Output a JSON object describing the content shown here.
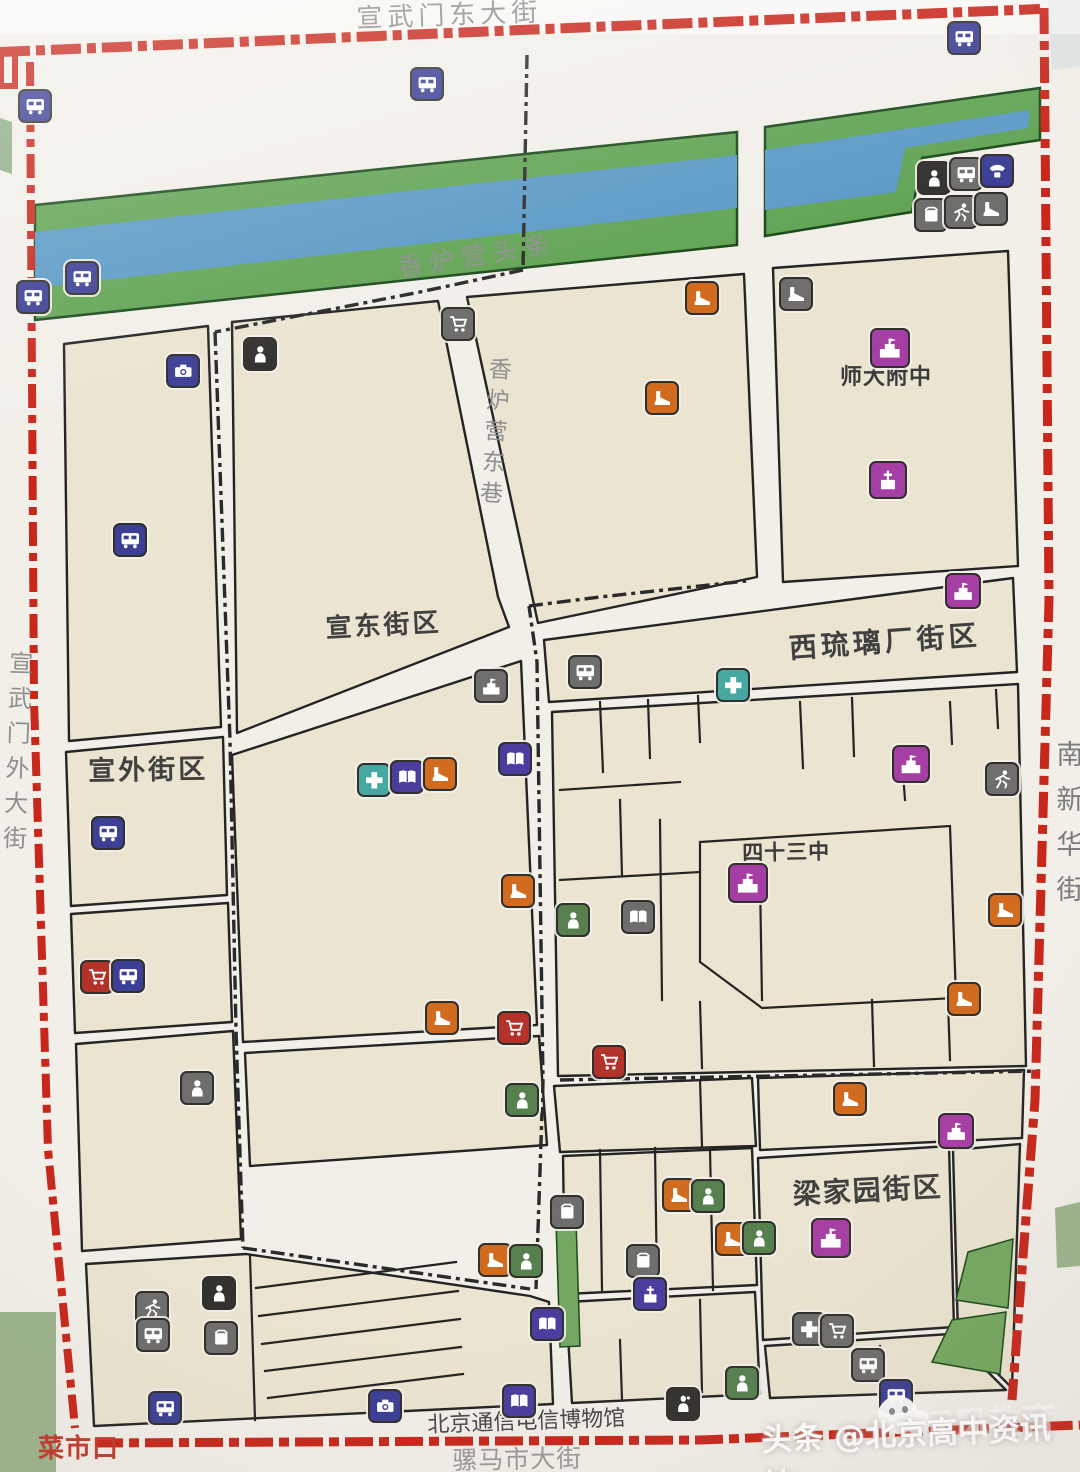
{
  "map": {
    "street_labels": [
      {
        "id": "xuanwumen-east-street",
        "text": "宣武门东大街",
        "x": 356,
        "y": 6,
        "size": 26,
        "ls": 5,
        "rot": -2,
        "color": "#8f8f8f",
        "vertical": false,
        "weight": 400
      },
      {
        "id": "xuanwumen-outer-street",
        "text": "宣武门外大街",
        "x": 6,
        "y": 650,
        "size": 24,
        "ls": 11,
        "rot": 2,
        "color": "#8f8f8f",
        "vertical": true,
        "weight": 400
      },
      {
        "id": "nanxinhua-street",
        "text": "南新华街",
        "x": 1052,
        "y": 740,
        "size": 27,
        "ls": 18,
        "rot": 0,
        "color": "#7c7c7c",
        "vertical": true,
        "weight": 400
      },
      {
        "id": "luomashi-street",
        "text": "骡马市大街",
        "x": 452,
        "y": 1448,
        "size": 25,
        "ls": 1,
        "rot": -1,
        "color": "#9a9a9a",
        "vertical": false,
        "weight": 400
      },
      {
        "id": "xiangluying-toutiao",
        "text": "香炉营头条",
        "x": 396,
        "y": 256,
        "size": 25,
        "ls": 7,
        "rot": -9,
        "color": "#8f8f8f",
        "vertical": false,
        "weight": 400
      },
      {
        "id": "xiangluying-dongxiang",
        "text": "香炉营东巷",
        "x": 486,
        "y": 356,
        "size": 23,
        "ls": 8,
        "rot": 4,
        "color": "#8f8f8f",
        "vertical": true,
        "weight": 400
      },
      {
        "id": "caishikou",
        "text": "菜市口",
        "x": 38,
        "y": 1436,
        "size": 26,
        "ls": 1,
        "rot": 0,
        "color": "#c23b2e",
        "vertical": false,
        "weight": 700
      },
      {
        "id": "telecom-museum",
        "text": "北京通信电信博物馆",
        "x": 427,
        "y": 1414,
        "size": 22,
        "ls": 0,
        "rot": -2,
        "color": "#474747",
        "vertical": false,
        "weight": 400
      }
    ],
    "region_labels": [
      {
        "id": "xuandong-block",
        "text": "宣东街区",
        "x": 325,
        "y": 616,
        "size": 26,
        "ls": 3,
        "rot": -3,
        "color": "#404040",
        "vertical": false,
        "weight": 700
      },
      {
        "id": "xuanwai-block",
        "text": "宣外街区",
        "x": 88,
        "y": 758,
        "size": 27,
        "ls": 3,
        "rot": -1,
        "color": "#404040",
        "vertical": false,
        "weight": 700
      },
      {
        "id": "xiliulichang-block",
        "text": "西琉璃厂街区",
        "x": 788,
        "y": 634,
        "size": 28,
        "ls": 4,
        "rot": -4,
        "color": "#404040",
        "vertical": false,
        "weight": 700
      },
      {
        "id": "shida-fuzhong",
        "text": "师大附中",
        "x": 840,
        "y": 366,
        "size": 22,
        "ls": 1,
        "rot": 0,
        "color": "#3a3a3a",
        "vertical": false,
        "weight": 700
      },
      {
        "id": "sishisan-zhong",
        "text": "四十三中",
        "x": 742,
        "y": 842,
        "size": 21,
        "ls": 1,
        "rot": -1,
        "color": "#3a3a3a",
        "vertical": false,
        "weight": 700
      },
      {
        "id": "liangjiayuan-block",
        "text": "梁家园街区",
        "x": 792,
        "y": 1180,
        "size": 28,
        "ls": 2,
        "rot": -3,
        "color": "#404040",
        "vertical": false,
        "weight": 700
      }
    ],
    "icon_colors": {
      "indigo": "#3c3f94",
      "violet": "#4a3d9e",
      "gray": "#6f6e6c",
      "black": "#33312e",
      "magenta": "#a63fa4",
      "teal": "#46a8a0",
      "orange": "#d06b20",
      "red": "#b33229",
      "green": "#57804f"
    },
    "icons": [
      {
        "t": "bus",
        "c": "indigo",
        "x": 33,
        "y": 104
      },
      {
        "t": "bus",
        "c": "indigo",
        "x": 425,
        "y": 82
      },
      {
        "t": "bus",
        "c": "indigo",
        "x": 962,
        "y": 36
      },
      {
        "t": "bus",
        "c": "indigo",
        "x": 80,
        "y": 276
      },
      {
        "t": "bus",
        "c": "indigo",
        "x": 31,
        "y": 295
      },
      {
        "t": "person",
        "c": "black",
        "x": 932,
        "y": 176
      },
      {
        "t": "bus",
        "c": "gray",
        "x": 964,
        "y": 172
      },
      {
        "t": "phone",
        "c": "indigo",
        "x": 995,
        "y": 169
      },
      {
        "t": "box",
        "c": "gray",
        "x": 929,
        "y": 213
      },
      {
        "t": "runner",
        "c": "gray",
        "x": 959,
        "y": 210
      },
      {
        "t": "shoe",
        "c": "gray",
        "x": 989,
        "y": 207
      },
      {
        "t": "camera",
        "c": "indigo",
        "x": 181,
        "y": 369
      },
      {
        "t": "person",
        "c": "black",
        "x": 258,
        "y": 352
      },
      {
        "t": "cart",
        "c": "gray",
        "x": 456,
        "y": 322
      },
      {
        "t": "shoe",
        "c": "orange",
        "x": 700,
        "y": 296
      },
      {
        "t": "shoe",
        "c": "gray",
        "x": 794,
        "y": 292
      },
      {
        "t": "school",
        "c": "magenta",
        "x": 888,
        "y": 346,
        "s": 36
      },
      {
        "t": "church",
        "c": "magenta",
        "x": 886,
        "y": 478,
        "s": 34
      },
      {
        "t": "shoe",
        "c": "orange",
        "x": 660,
        "y": 396
      },
      {
        "t": "bus",
        "c": "indigo",
        "x": 128,
        "y": 538
      },
      {
        "t": "school",
        "c": "magenta",
        "x": 961,
        "y": 589,
        "s": 32
      },
      {
        "t": "school",
        "c": "gray",
        "x": 489,
        "y": 684
      },
      {
        "t": "bus",
        "c": "gray",
        "x": 583,
        "y": 670
      },
      {
        "t": "cross",
        "c": "teal",
        "x": 731,
        "y": 683
      },
      {
        "t": "cross",
        "c": "teal",
        "x": 372,
        "y": 778
      },
      {
        "t": "book",
        "c": "violet",
        "x": 405,
        "y": 775
      },
      {
        "t": "shoe",
        "c": "orange",
        "x": 438,
        "y": 772
      },
      {
        "t": "book",
        "c": "violet",
        "x": 513,
        "y": 757
      },
      {
        "t": "school",
        "c": "magenta",
        "x": 909,
        "y": 762,
        "s": 34
      },
      {
        "t": "runner",
        "c": "gray",
        "x": 1000,
        "y": 777
      },
      {
        "t": "bus",
        "c": "indigo",
        "x": 106,
        "y": 831
      },
      {
        "t": "school",
        "c": "magenta",
        "x": 746,
        "y": 881,
        "s": 36
      },
      {
        "t": "book",
        "c": "gray",
        "x": 636,
        "y": 915
      },
      {
        "t": "person",
        "c": "green",
        "x": 571,
        "y": 918
      },
      {
        "t": "shoe",
        "c": "orange",
        "x": 516,
        "y": 889
      },
      {
        "t": "shoe",
        "c": "orange",
        "x": 1003,
        "y": 908
      },
      {
        "t": "cart",
        "c": "red",
        "x": 95,
        "y": 975
      },
      {
        "t": "bus",
        "c": "indigo",
        "x": 126,
        "y": 974
      },
      {
        "t": "shoe",
        "c": "orange",
        "x": 962,
        "y": 997
      },
      {
        "t": "shoe",
        "c": "orange",
        "x": 440,
        "y": 1016
      },
      {
        "t": "cart",
        "c": "red",
        "x": 512,
        "y": 1026
      },
      {
        "t": "cart",
        "c": "red",
        "x": 607,
        "y": 1060
      },
      {
        "t": "person",
        "c": "gray",
        "x": 195,
        "y": 1086
      },
      {
        "t": "person",
        "c": "green",
        "x": 520,
        "y": 1098
      },
      {
        "t": "shoe",
        "c": "orange",
        "x": 848,
        "y": 1097
      },
      {
        "t": "school",
        "c": "magenta",
        "x": 954,
        "y": 1129,
        "s": 32
      },
      {
        "t": "shoe",
        "c": "orange",
        "x": 677,
        "y": 1193
      },
      {
        "t": "person",
        "c": "green",
        "x": 706,
        "y": 1194
      },
      {
        "t": "box",
        "c": "gray",
        "x": 565,
        "y": 1210
      },
      {
        "t": "school",
        "c": "magenta",
        "x": 829,
        "y": 1236,
        "s": 36
      },
      {
        "t": "shoe",
        "c": "orange",
        "x": 730,
        "y": 1237
      },
      {
        "t": "person",
        "c": "green",
        "x": 757,
        "y": 1236
      },
      {
        "t": "shoe",
        "c": "orange",
        "x": 493,
        "y": 1258
      },
      {
        "t": "person",
        "c": "green",
        "x": 524,
        "y": 1259
      },
      {
        "t": "box",
        "c": "gray",
        "x": 641,
        "y": 1259
      },
      {
        "t": "church",
        "c": "violet",
        "x": 648,
        "y": 1292
      },
      {
        "t": "runner",
        "c": "gray",
        "x": 150,
        "y": 1306
      },
      {
        "t": "bus",
        "c": "gray",
        "x": 151,
        "y": 1333
      },
      {
        "t": "person",
        "c": "black",
        "x": 217,
        "y": 1291
      },
      {
        "t": "box",
        "c": "gray",
        "x": 219,
        "y": 1336
      },
      {
        "t": "bus",
        "c": "indigo",
        "x": 163,
        "y": 1406
      },
      {
        "t": "camera",
        "c": "indigo",
        "x": 383,
        "y": 1404
      },
      {
        "t": "book",
        "c": "violet",
        "x": 545,
        "y": 1322
      },
      {
        "t": "book",
        "c": "violet",
        "x": 517,
        "y": 1399
      },
      {
        "t": "police",
        "c": "black",
        "x": 681,
        "y": 1402
      },
      {
        "t": "person",
        "c": "green",
        "x": 740,
        "y": 1381
      },
      {
        "t": "cross",
        "c": "gray",
        "x": 807,
        "y": 1327
      },
      {
        "t": "cart",
        "c": "gray",
        "x": 835,
        "y": 1329
      },
      {
        "t": "bus",
        "c": "gray",
        "x": 866,
        "y": 1363
      },
      {
        "t": "bus",
        "c": "indigo",
        "x": 894,
        "y": 1394
      }
    ],
    "palette": {
      "paper": "#f2efe9",
      "block": "#eae4d0",
      "outline": "#242424",
      "river_green": "#62a455",
      "river_blue": "#5b9ac6",
      "park_green": "#74a862",
      "border_red": "#c8271c",
      "boundary_black": "#2a2a2a"
    },
    "watermark": {
      "main": "头条 @北京高中资讯站",
      "behind": "闻风教育"
    }
  }
}
